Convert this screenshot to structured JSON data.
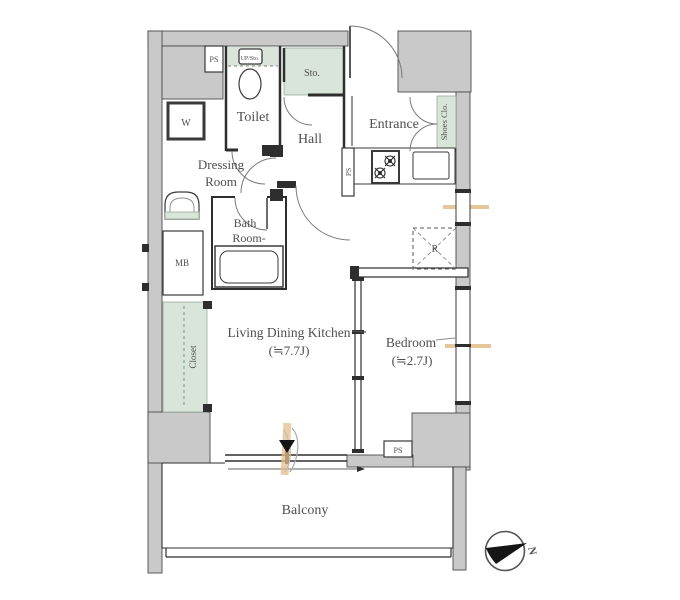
{
  "title": "apartment-floor-plan",
  "colors": {
    "wall_fill": "#c9c9c9",
    "wall_stroke": "#4a4a4a",
    "accent_green": "#d9e5da",
    "accent_tan": "#e2bd8a",
    "line": "#2e2e2e",
    "text": "#4f4f4f",
    "background": "#ffffff"
  },
  "rooms": {
    "toilet": "Toilet",
    "hall": "Hall",
    "entrance": "Entrance",
    "shoes_closet": "Shoes Clo.",
    "storage": "Sto.",
    "upper_storage": "UP/Sto.",
    "dressing_line1": "Dressing",
    "dressing_line2": "Room",
    "bath_line1": "Bath",
    "bath_line2": "Room-",
    "ldk_line1": "Living Dining Kitchen",
    "ldk_line2": "(≒7.7J)",
    "bedroom_line1": "Bedroom",
    "bedroom_line2": "(≒2.7J)",
    "balcony": "Balcony",
    "closet": "Closet"
  },
  "fixtures": {
    "washing_machine": "W",
    "meter_box": "MB",
    "refrigerator": "R",
    "ps_top": "PS",
    "ps_kitchen": "PS",
    "ps_bottom": "PS"
  },
  "compass": {
    "north": "N"
  }
}
